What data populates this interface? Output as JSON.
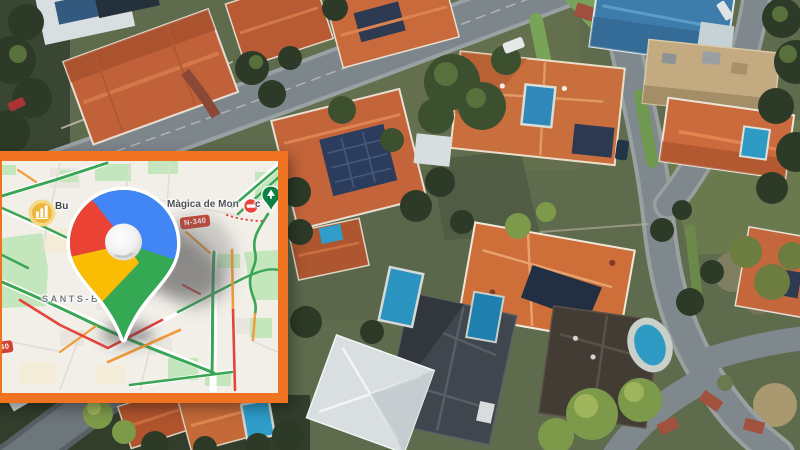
{
  "inset_map": {
    "frame_color": "#ef7320",
    "labels": {
      "poi": "Bu",
      "place": "Màgica de Mon",
      "place_suffix": "c",
      "district": "SANTS-B",
      "shield_top": "N-340",
      "shield_bottom": "N-340"
    },
    "icons": {
      "logo": "google-maps-pin",
      "poi_badge": "busy-area-bar-chart-icon",
      "closure": "road-closure-icon",
      "park": "park-attraction-pin-icon"
    },
    "logo_colors": {
      "red": "#ea4335",
      "blue": "#4285f4",
      "yellow": "#fbbc04",
      "green": "#34a853"
    },
    "traffic_colors": {
      "fast": "#3aa655",
      "slow": "#f29b38",
      "jam": "#e5443a"
    }
  },
  "photo_palette": {
    "roof_orange": "#c1613a",
    "roof_blue": "#3d7cab",
    "roof_white": "#dce1e2",
    "roof_slate": "#3f464d",
    "roof_tan": "#c3aa80",
    "pool_blue": "#2d9bc4",
    "road_gray": "#7f898d",
    "tree_dark": "#2c3a27",
    "tree_bright": "#7d9a4a"
  }
}
